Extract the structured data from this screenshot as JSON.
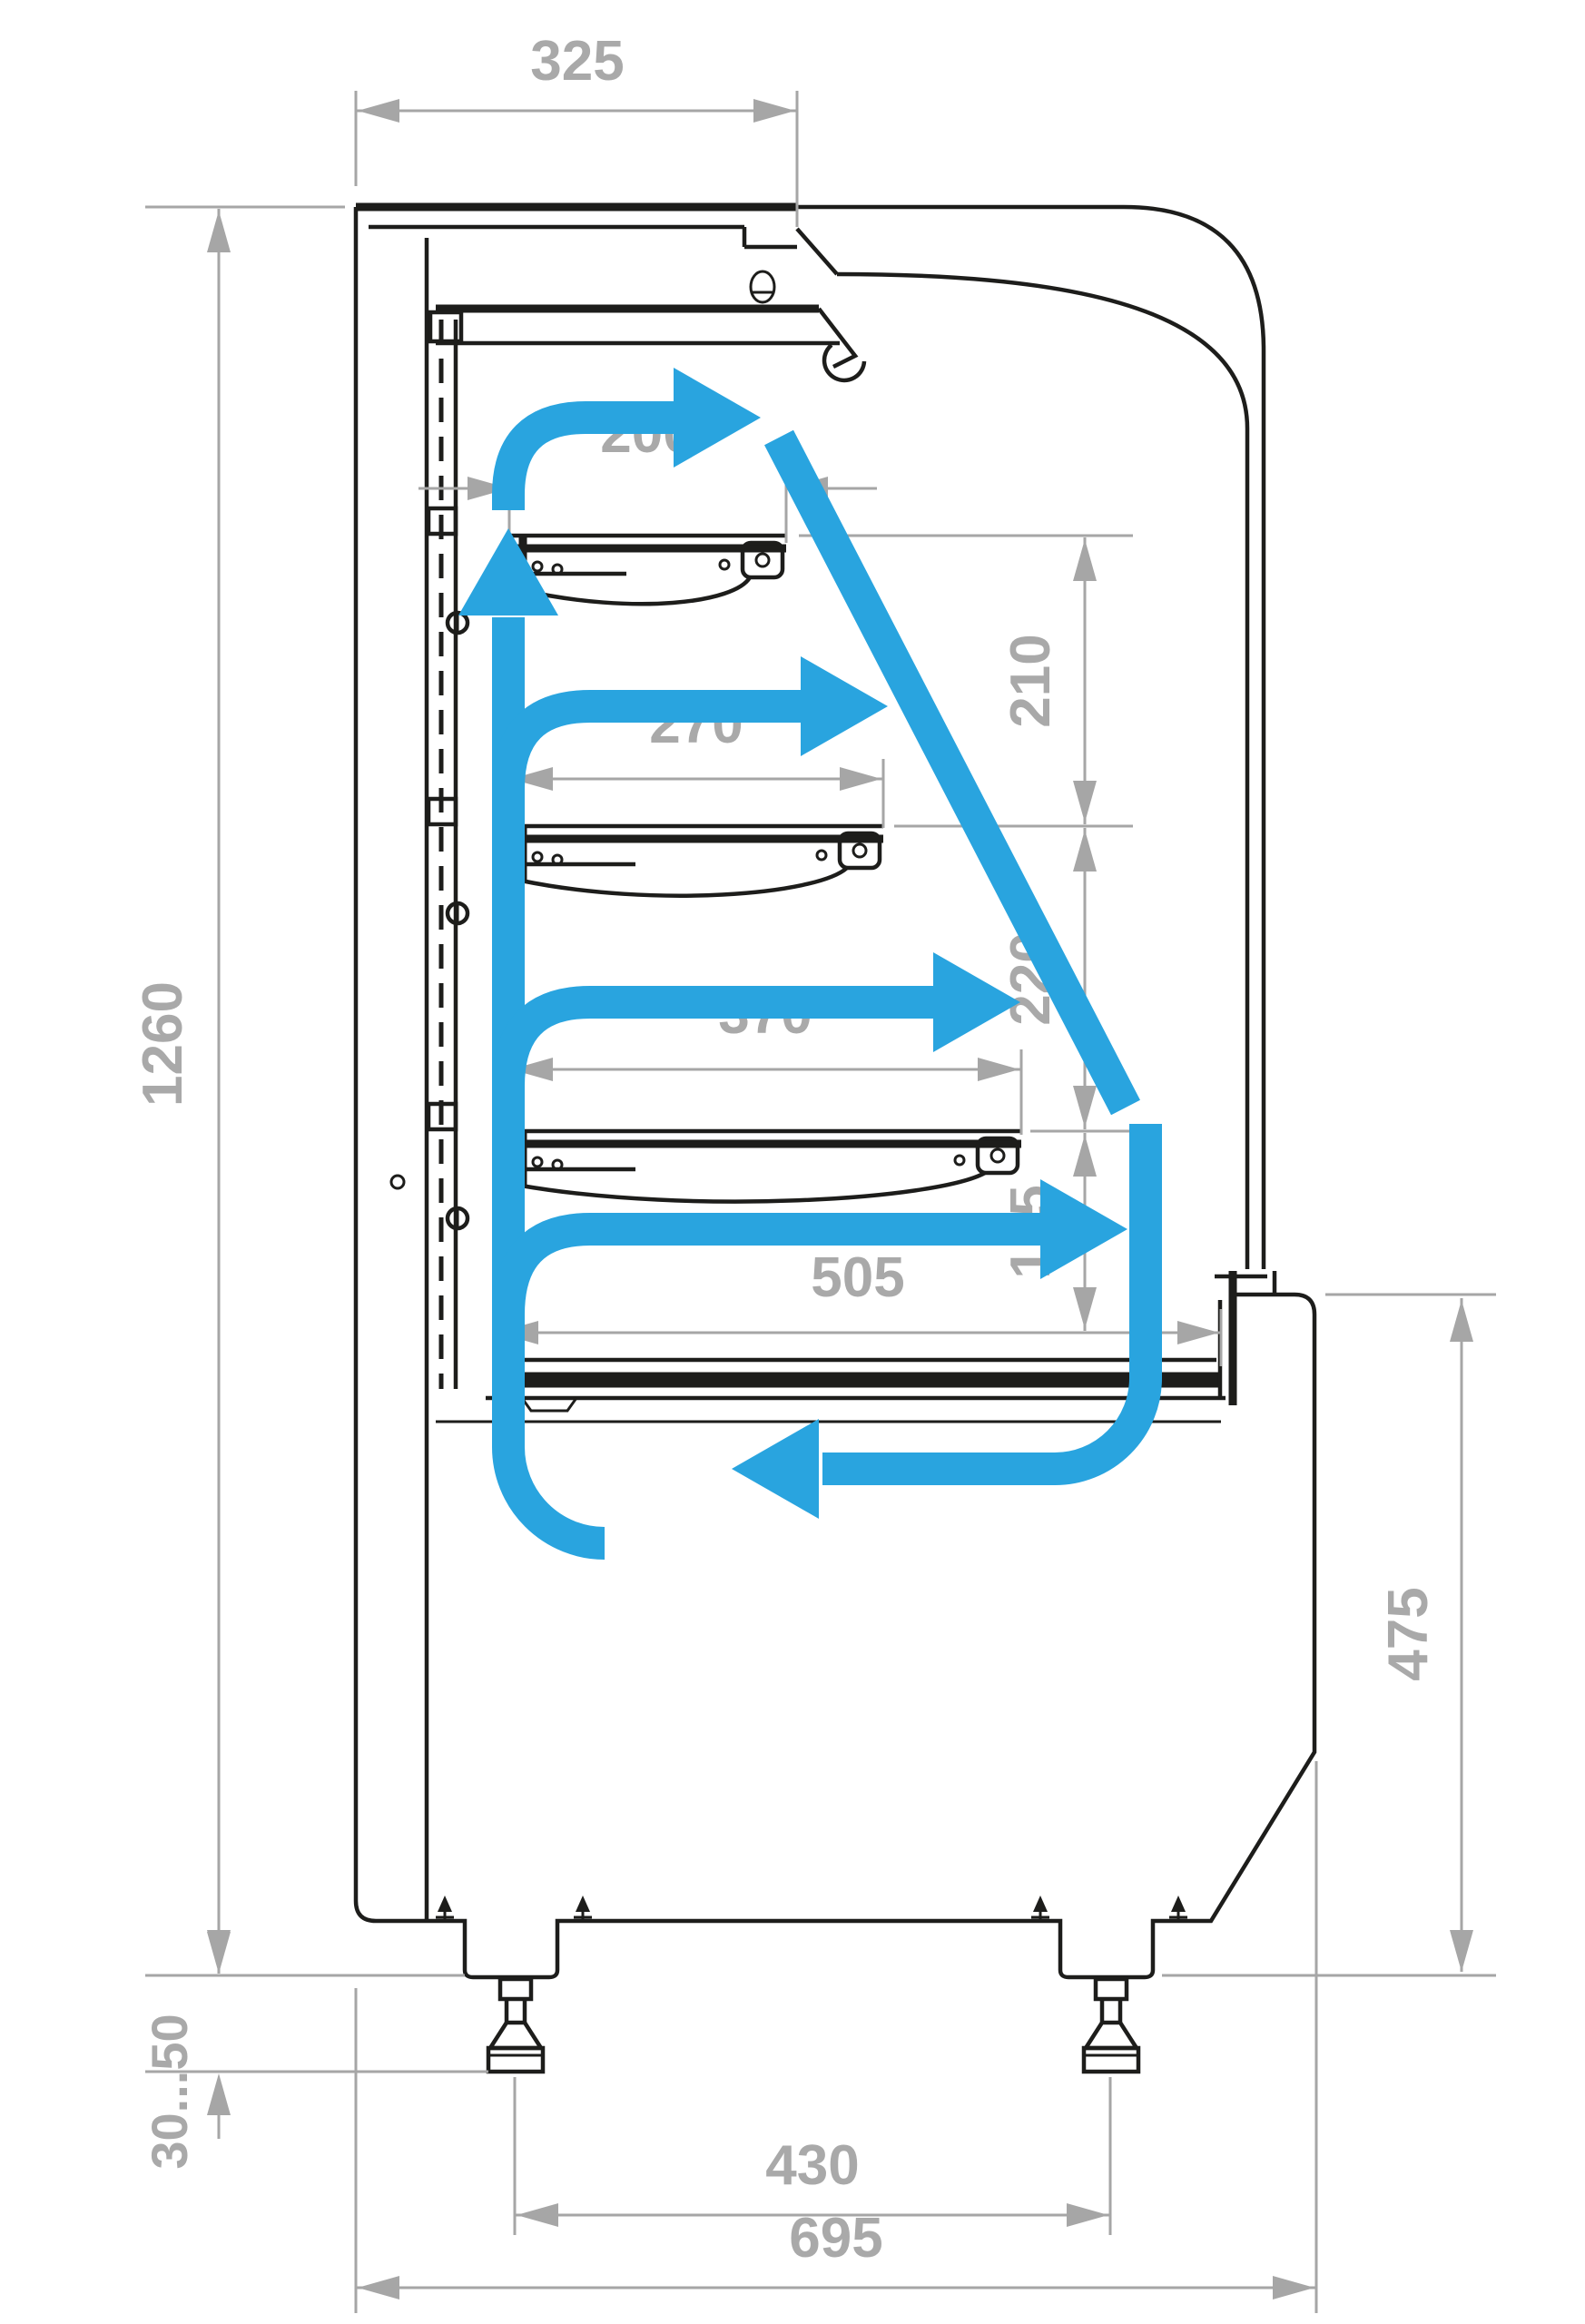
{
  "dimensions": {
    "top_depth": "325",
    "shelf_1_depth": "200",
    "shelf_2_depth": "270",
    "shelf_3_depth": "370",
    "base_shelf_depth": "505",
    "shelf_1_to_2_height": "210",
    "shelf_2_to_3_height": "220",
    "shelf_3_to_base_height": "175",
    "overall_height": "1260",
    "front_base_height": "475",
    "leg_adjust_range": "30...50",
    "leg_spacing": "430",
    "overall_depth": "695"
  },
  "colors": {
    "outline": "#1d1d1b",
    "dimension_gray": "#a6a6a6",
    "dimension_text_gray": "#a9a9a9",
    "airflow_blue": "#29a4df",
    "background": "#ffffff"
  },
  "airflow": {
    "arrows": [
      "riser-up-back-wall",
      "outlet-above-shelf-1",
      "across-gap-shelf-2",
      "across-gap-shelf-3",
      "across-base-shelf",
      "down-along-front-glass",
      "return-under-deck"
    ]
  }
}
